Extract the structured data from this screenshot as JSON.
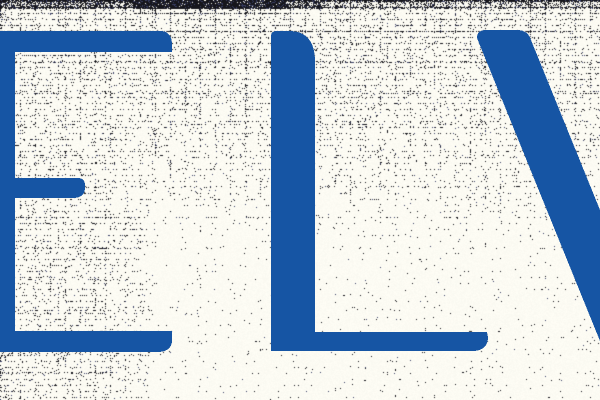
{
  "logo": {
    "visible_text": "ELV",
    "letter_color": "#1655a4",
    "letters": [
      {
        "char": "E",
        "visibility": "cut off at left edge"
      },
      {
        "char": "L",
        "visibility": "fully visible"
      },
      {
        "char": "V",
        "visibility": "left stroke only, cut off at right edge"
      }
    ]
  },
  "texture": {
    "paper_color": "#fdfcf4",
    "dot_color": "#16161c",
    "dot_accent_color": "#3a4066"
  }
}
